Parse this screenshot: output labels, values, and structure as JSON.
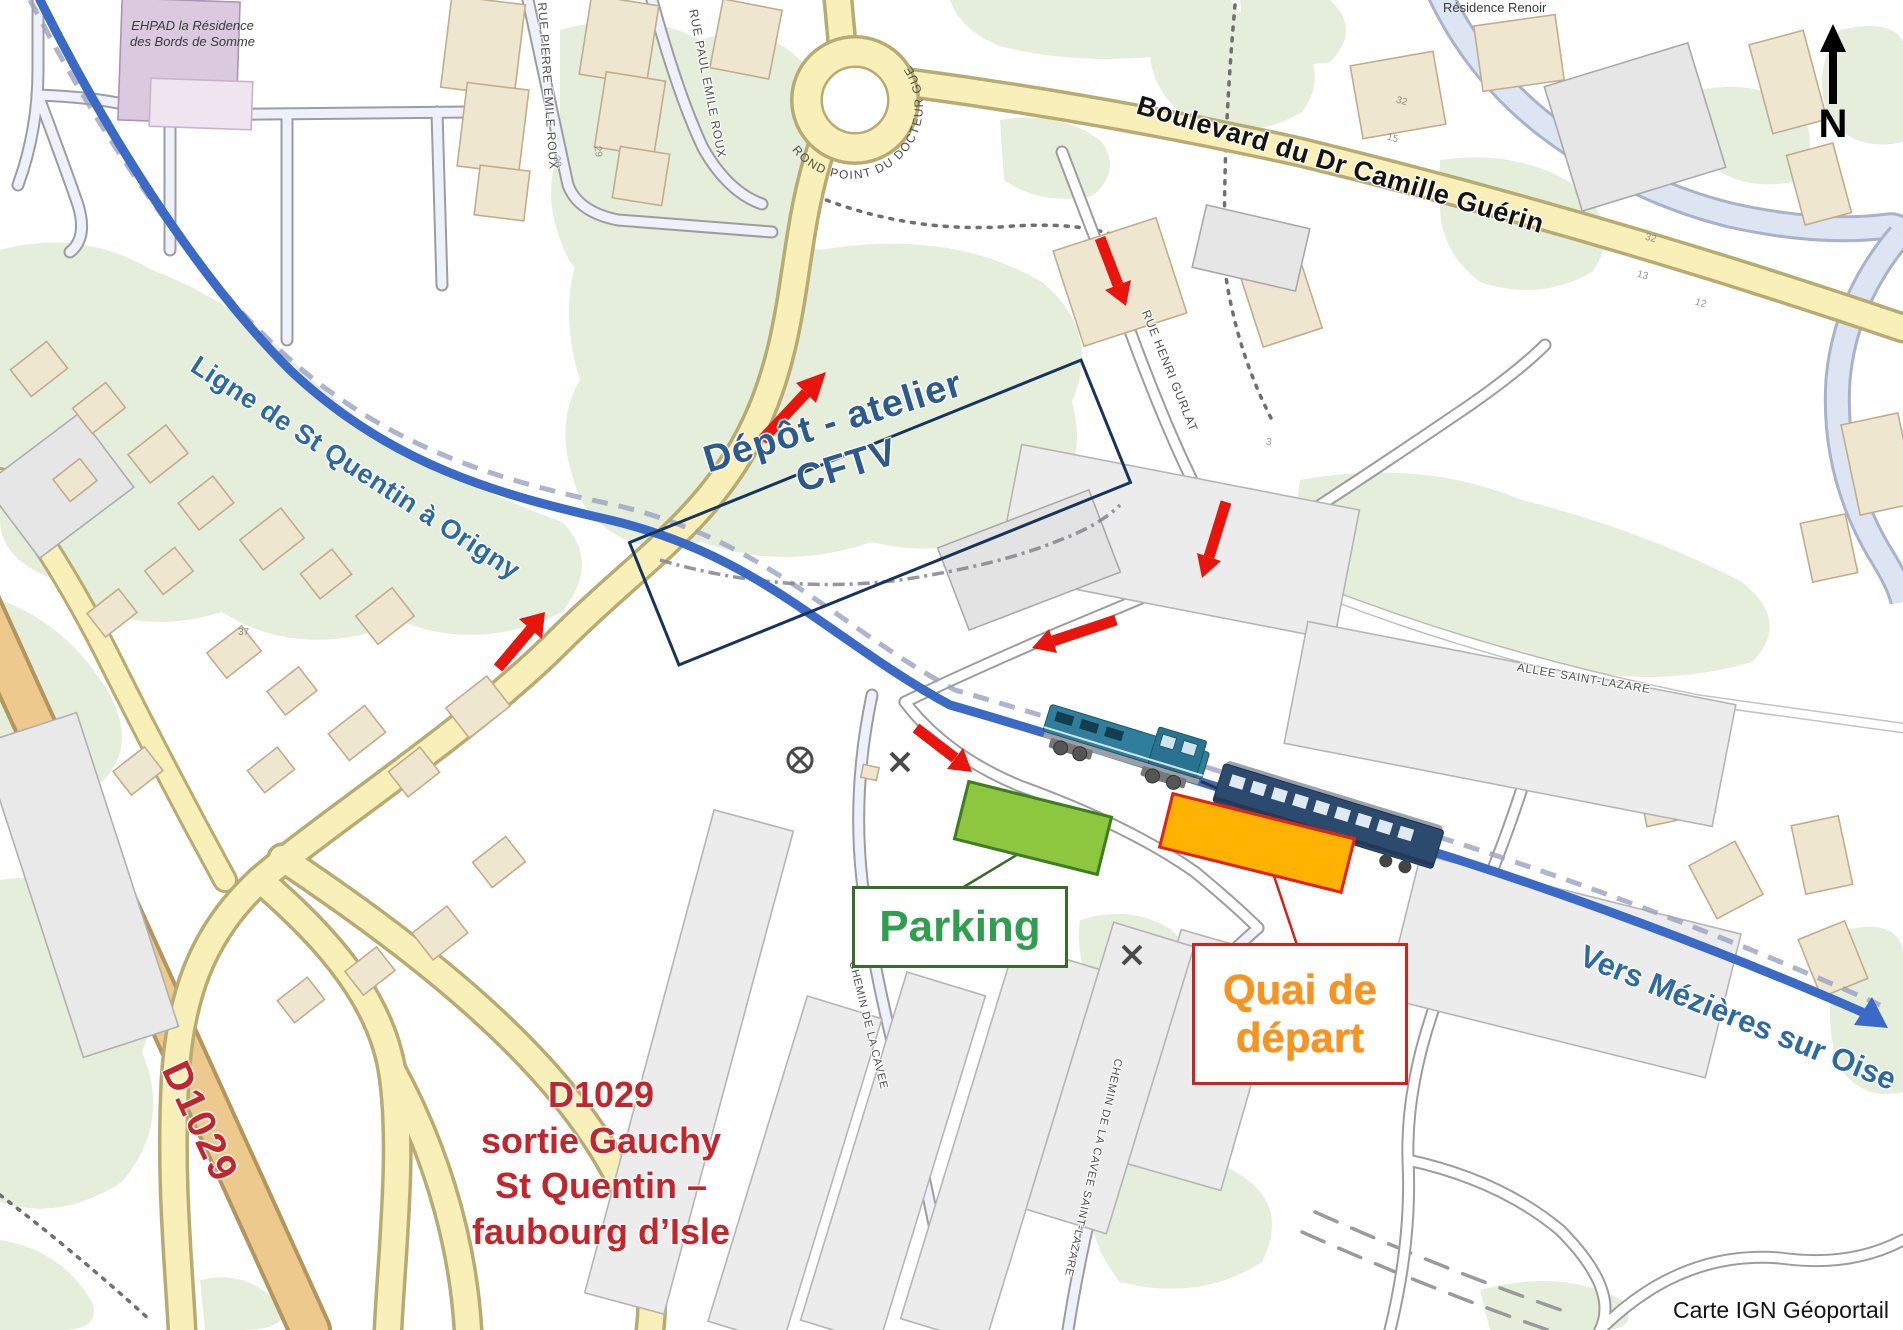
{
  "labels": {
    "ehpad": {
      "line1": "EHPAD la Résidence",
      "line2": "des Bords de Somme"
    },
    "residence_renoir": "Résidence Renoir",
    "boulevard": "Boulevard du Dr Camille Guérin",
    "rond_point": "ROND POINT DU DOCTEUR GUERIN",
    "rue_pierre_emile_roux": "RUE PIERRE EMILE ROUX",
    "rue_paul_emile_roux": "RUE PAUL EMILE ROUX",
    "rue_henri_gurlat": "RUE HENRI GURLAT",
    "allee_saint_lazare": "ALLEE SAINT-LAZARE",
    "chemin_de_la_cavee": "CHEMIN DE LA CAVEE",
    "chemin_cavee_saint_lazare": "CHEMIN DE LA CAVEE SAINT-LAZARE",
    "ligne": "Ligne de St Quentin à Origny",
    "vers_mezieres": "Vers Mézières sur Oise",
    "depot": {
      "line1": "Dépôt - atelier",
      "line2": "CFTV"
    },
    "parking": "Parking",
    "quai": {
      "line1": "Quai de",
      "line2": "départ"
    },
    "d1029_road": "D1029",
    "d1029_note": {
      "line1": "D1029",
      "line2": "sortie Gauchy",
      "line3": "St Quentin –",
      "line4": "faubourg d’Isle"
    },
    "north": "N",
    "attribution": "Carte IGN Géoportail"
  },
  "house_numbers": [
    {
      "t": "32"
    },
    {
      "t": "15"
    },
    {
      "t": "32"
    },
    {
      "t": "13"
    },
    {
      "t": "12"
    },
    {
      "t": "30"
    },
    {
      "t": "29"
    },
    {
      "t": "37"
    },
    {
      "t": "3"
    }
  ],
  "colors": {
    "route_blue": "#3a6ac5",
    "rail_label_blue": "#2d6aa3",
    "arrow_red": "#e8150d",
    "parking_fill": "#8dc63f",
    "parking_border": "#3f7d23",
    "parking_text": "#2f9e4e",
    "quai_fill": "#ffb300",
    "quai_border": "#e32119",
    "quai_text": "#f7941d",
    "depot_navy": "#16355e",
    "depot_text": "#2d5a8e",
    "d1029_red": "#c0262c",
    "road_yellow": "#f9efb8",
    "road_orange": "#eec98d",
    "green_area": "#e5eedb"
  }
}
